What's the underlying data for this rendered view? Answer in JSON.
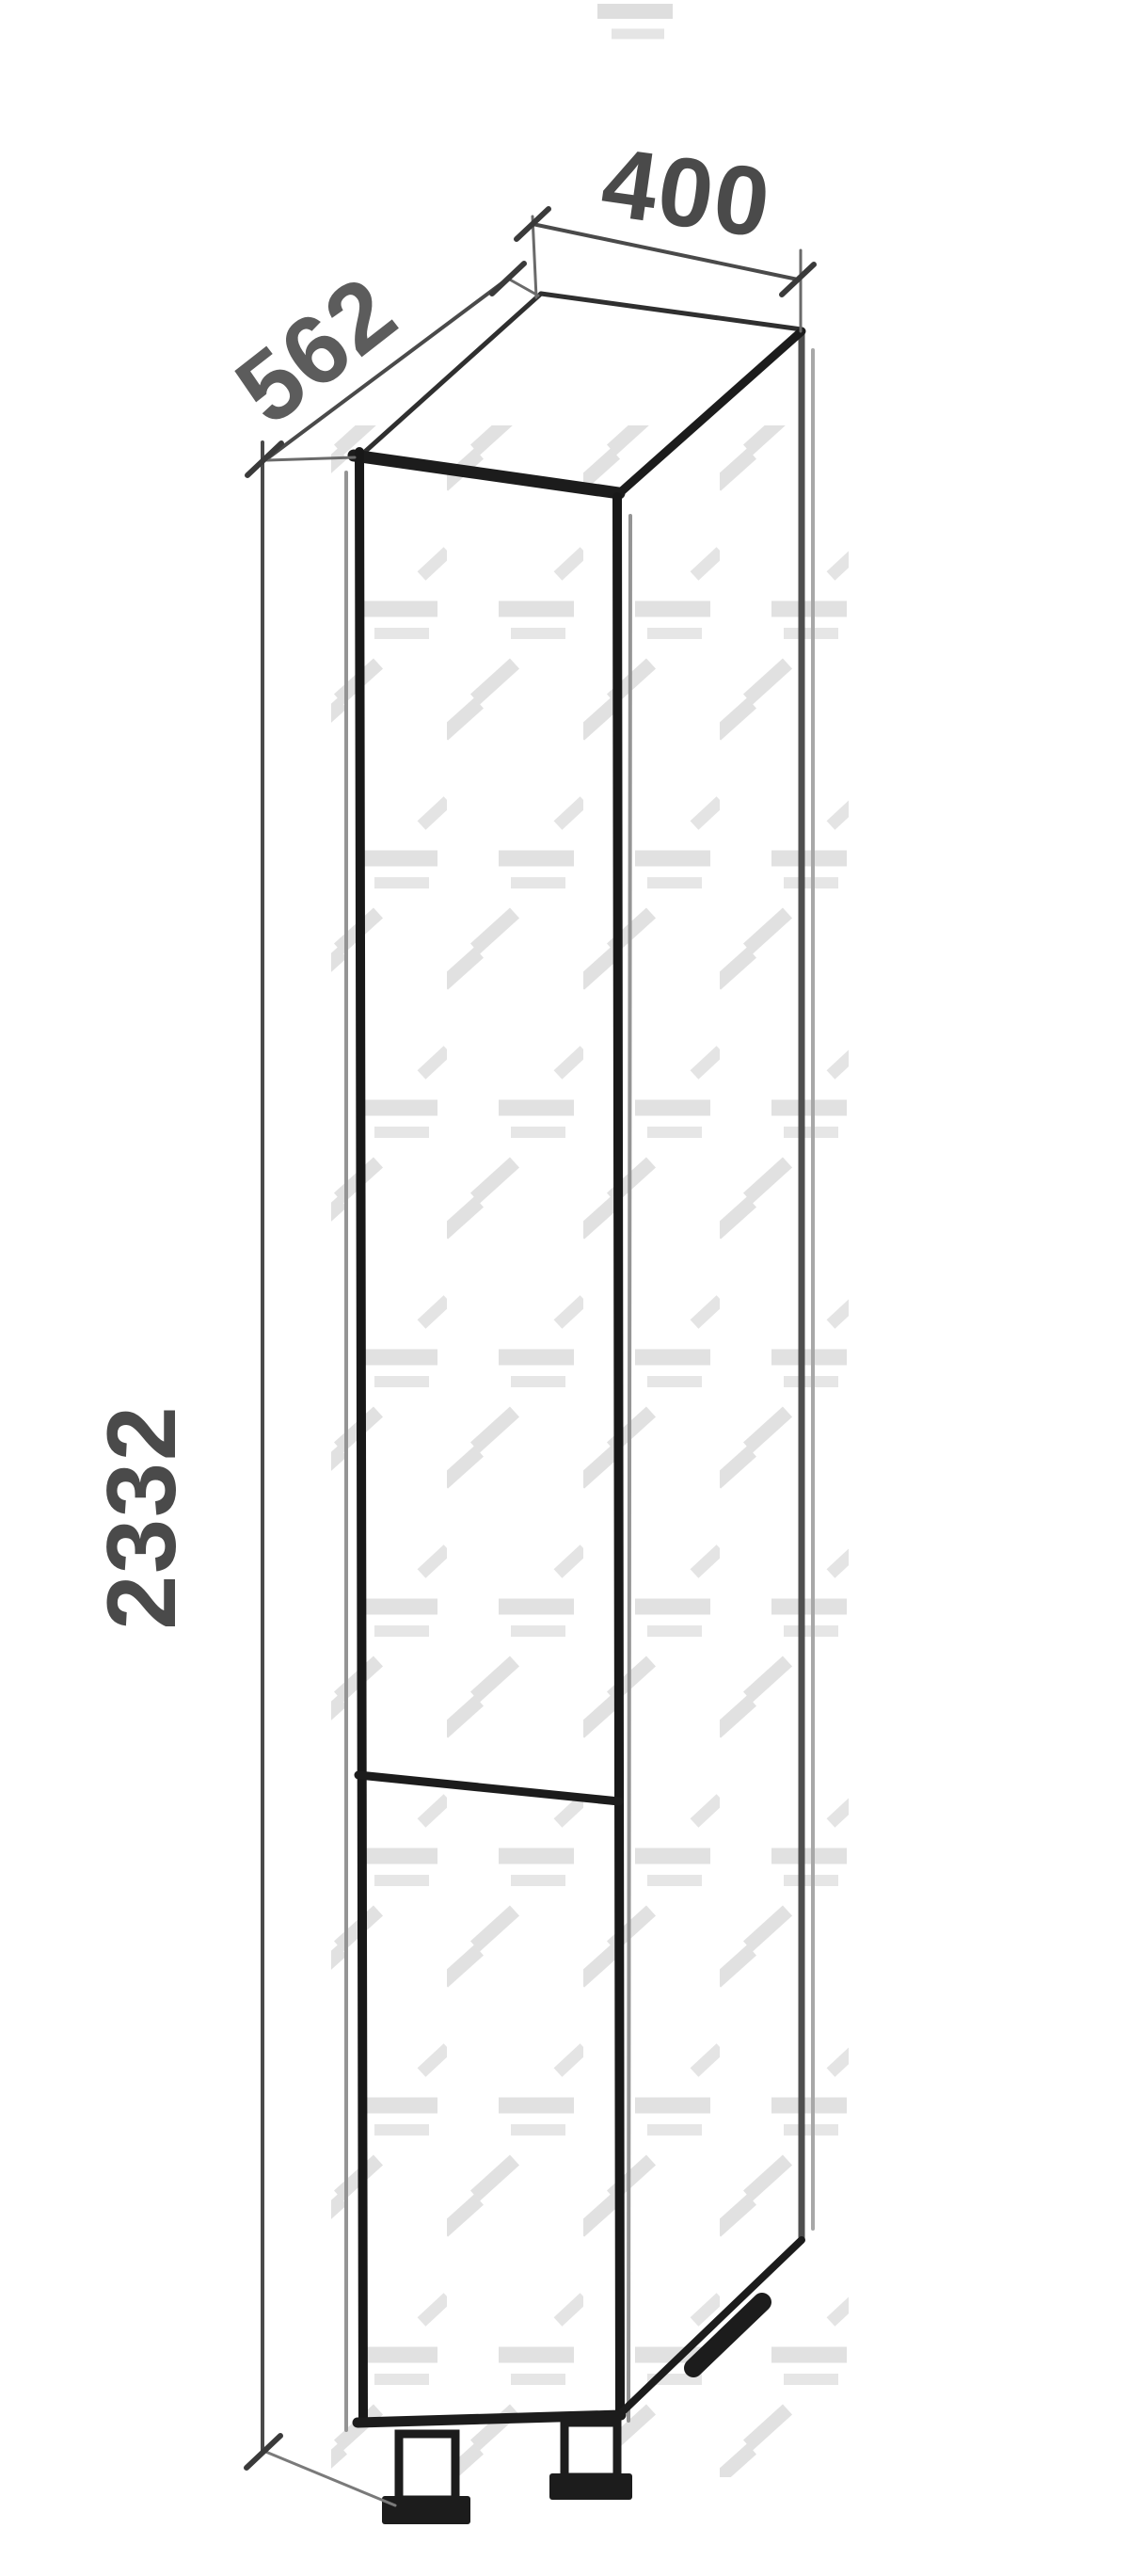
{
  "drawing": {
    "kind": "furniture-dimension-drawing",
    "view": "axonometric tall cabinet with split door and feet",
    "dimensions": {
      "width": "400",
      "depth": "562",
      "height": "2332"
    },
    "colors": {
      "background": "#ffffff",
      "outline": "#1c1c1c",
      "carcass_line": "#949494",
      "back_edge": "#4f4f4f",
      "dimension_line": "#4a4a4a",
      "label_text": "#4a4a4a",
      "watermark": "#c8c8c8"
    }
  }
}
